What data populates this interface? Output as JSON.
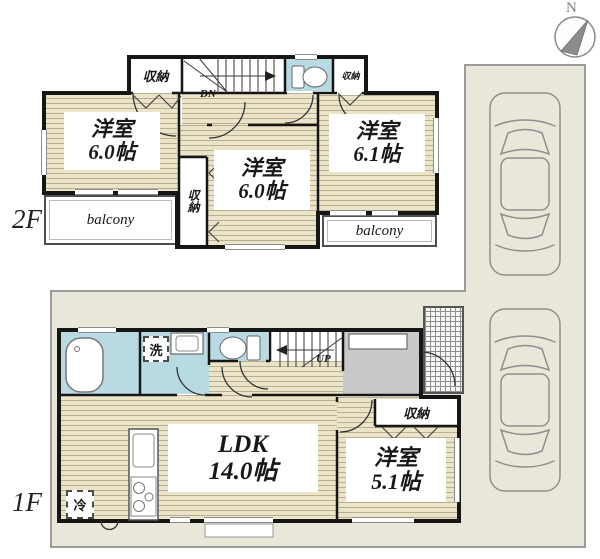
{
  "compass": {
    "north": "N"
  },
  "floor2": {
    "label": "2F",
    "stairs_label": "DN",
    "closet_top_left": "収納",
    "closet_top_right": "収納",
    "closet_middle": "収納",
    "room_west": {
      "name": "洋室",
      "size": "6.0帖"
    },
    "room_center": {
      "name": "洋室",
      "size": "6.0帖"
    },
    "room_east": {
      "name": "洋室",
      "size": "6.1帖"
    },
    "balcony_west": "balcony",
    "balcony_east": "balcony"
  },
  "floor1": {
    "label": "1F",
    "stairs_label": "UP",
    "laundry_label": "洗",
    "fridge_label": "冷",
    "closet": "収納",
    "ldk": {
      "name": "LDK",
      "size": "14.0帖"
    },
    "room_south": {
      "name": "洋室",
      "size": "5.1帖"
    }
  },
  "colors": {
    "wood_floor": "#ece4c8",
    "water_room": "#b7dae3",
    "ground": "#e9e7d9",
    "wall": "#161616",
    "entrance_gray": "#c9c9c9"
  }
}
